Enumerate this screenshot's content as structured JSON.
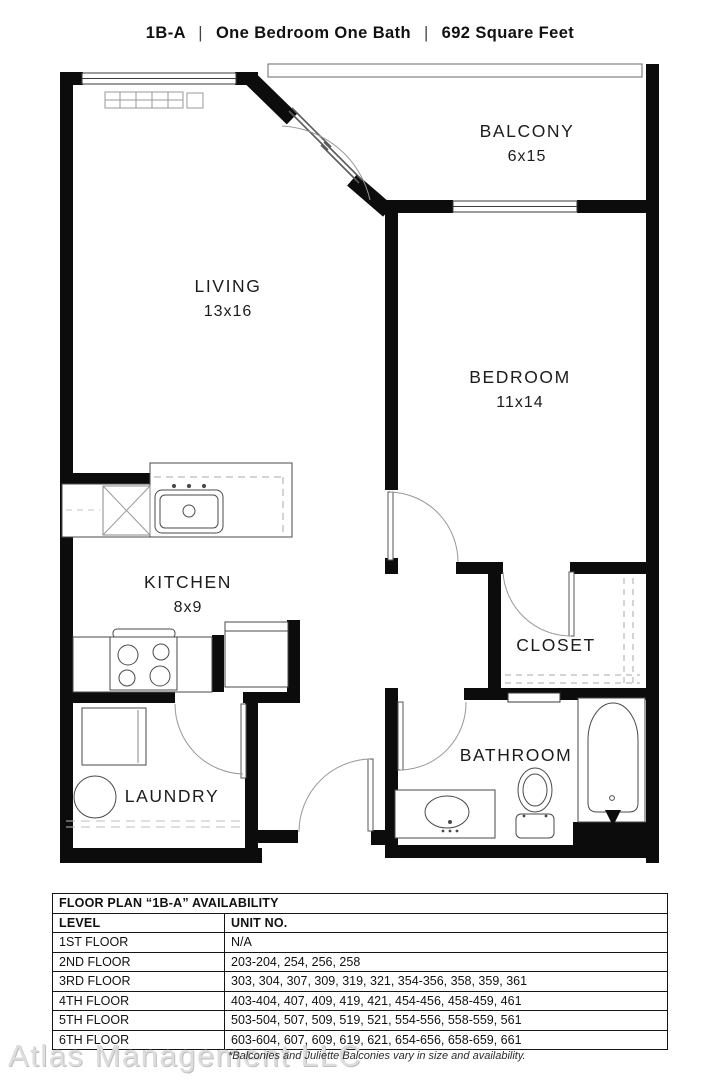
{
  "header": {
    "plan_code": "1B-A",
    "separator": "|",
    "description": "One Bedroom One Bath",
    "area": "692 Square Feet"
  },
  "rooms": {
    "balcony": {
      "name": "BALCONY",
      "dims": "6x15"
    },
    "living": {
      "name": "LIVING",
      "dims": "13x16"
    },
    "bedroom": {
      "name": "BEDROOM",
      "dims": "11x14"
    },
    "kitchen": {
      "name": "KITCHEN",
      "dims": "8x9"
    },
    "closet": {
      "name": "CLOSET"
    },
    "bathroom": {
      "name": "BATHROOM"
    },
    "laundry": {
      "name": "LAUNDRY"
    }
  },
  "availability_table": {
    "title": "FLOOR PLAN “1B-A” AVAILABILITY",
    "columns": {
      "level": "LEVEL",
      "unit_no": "UNIT NO."
    },
    "rows": [
      {
        "level": "1ST FLOOR",
        "units": "N/A"
      },
      {
        "level": "2ND FLOOR",
        "units": "203-204, 254, 256, 258"
      },
      {
        "level": "3RD FLOOR",
        "units": "303, 304, 307, 309, 319, 321, 354-356, 358, 359, 361"
      },
      {
        "level": "4TH FLOOR",
        "units": "403-404, 407, 409, 419, 421, 454-456, 458-459, 461"
      },
      {
        "level": "5TH FLOOR",
        "units": "503-504, 507, 509, 519, 521, 554-556, 558-559, 561"
      },
      {
        "level": "6TH FLOOR",
        "units": "603-604, 607, 609, 619, 621, 654-656, 658-659, 661"
      }
    ]
  },
  "footer": {
    "watermark": "Atlas Management LLC",
    "note": "*Balconies and Juliette Balconies vary in size and availability."
  },
  "colors": {
    "wall": "#0c0c0c",
    "fixture_line": "#4a4a4a",
    "arc_line": "#8f8f8f",
    "dashed_line": "#a8a8a8",
    "watermark": "#dddddd"
  }
}
